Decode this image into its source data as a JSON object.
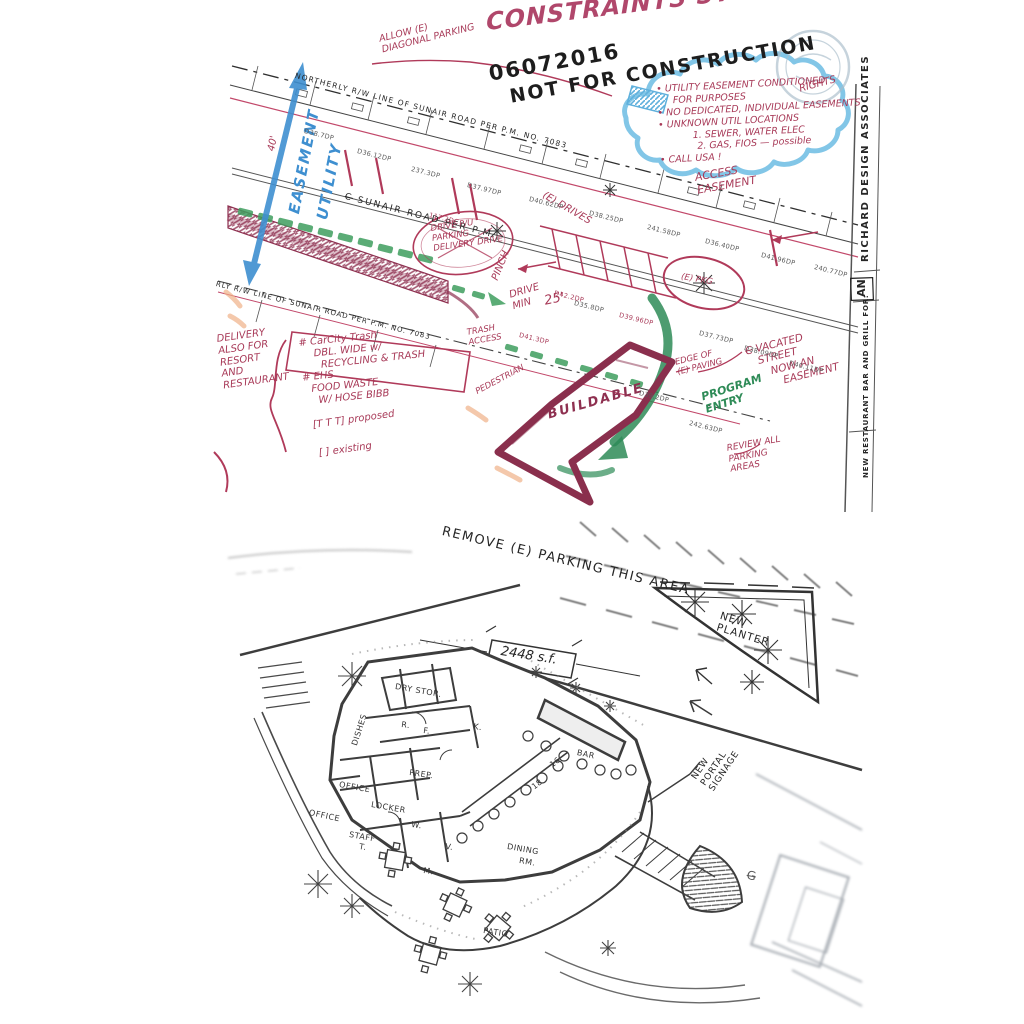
{
  "top_sheet": {
    "title": "CONSTRAINTS STUDY",
    "date": "06072016",
    "stamp": "NOT FOR CONSTRUCTION",
    "allow_parking_lines": [
      "ALLOW (E)",
      "DIAGONAL PARKING"
    ],
    "cloud_note_lines": [
      "• UTILITY EASEMENT CONDITIONED",
      "FOR PURPOSES",
      "• NO DEDICATED, INDIVIDUAL EASEMENTS",
      "• UNKNOWN UTIL LOCATIONS",
      "1. SEWER, WATER ELEC",
      "2. GAS, FIOS — possible",
      "• CALL USA !"
    ],
    "rights_note": "RIGHTS",
    "access_easement_lines": [
      "ACCESS",
      "EASEMENT"
    ],
    "northerly_rw": "NORTHERLY R/W LINE OF SUNAIR ROAD PER P.M. NO. 7083",
    "centerline_road": "C SUNAIR ROAD PER P.M.",
    "southerly_rw": "RLY R/W LINE OF SUNAIR ROAD PER P.M. NO. 7083",
    "easement_word": "EASEMENT",
    "utility_word": "UTILITY",
    "easement_width": "40'",
    "e_drives": "(E) DRIVES",
    "drive_cloud_lines": [
      "DRIVE P/U",
      "PARKING",
      "DELIVERY DRIVE"
    ],
    "pinch": "PINCH",
    "drive_min_lines": [
      "DRIVE",
      "MIN"
    ],
    "drive_dim": "25'",
    "e_pkg": "(E) PKG",
    "trash_access_lines": [
      "TRASH",
      "ACCESS"
    ],
    "pedestrian": "PEDESTRIAN",
    "buildable": "BUILDABLE",
    "program_entry_lines": [
      "PROGRAM",
      "ENTRY"
    ],
    "vacated_lines": [
      "C VACATED",
      "STREET",
      "NOW AN",
      "EASEMENT"
    ],
    "edge_paving_lines": [
      "EDGE OF",
      "(E) PAVING"
    ],
    "review_lines": [
      "REVIEW ALL",
      "PARKING",
      "AREAS"
    ],
    "delivery_lines": [
      "DELIVERY",
      "ALSO FOR",
      "RESORT",
      "AND",
      "RESTAURANT"
    ],
    "trash_note_lines": [
      "# CarCity Trash",
      "DBL. WIDE w/",
      "RECYCLING & TRASH",
      "# EHS",
      "FOOD WASTE",
      "W/ HOSE BIBB"
    ],
    "proposed_note": "[T T T]  proposed",
    "existing_note": "[ ]  existing",
    "titleblock_firm": "RICHARD DESIGN ASSOCIATES",
    "titleblock_logo": "AN",
    "titleblock_project": "NEW RESTAURANT BAR AND GRILL FOR:",
    "survey_marks": [
      {
        "text": "D38.7DP",
        "x": 305,
        "y": 128,
        "rot": 14
      },
      {
        "text": "D36.12DP",
        "x": 358,
        "y": 148,
        "rot": 14
      },
      {
        "text": "237.3DP",
        "x": 412,
        "y": 166,
        "rot": 14
      },
      {
        "text": "D37.97DP",
        "x": 468,
        "y": 182,
        "rot": 14
      },
      {
        "text": "D40.62DP",
        "x": 530,
        "y": 196,
        "rot": 14
      },
      {
        "text": "D38.25DP",
        "x": 590,
        "y": 210,
        "rot": 14
      },
      {
        "text": "241.58DP",
        "x": 648,
        "y": 224,
        "rot": 14
      },
      {
        "text": "D36.40DP",
        "x": 706,
        "y": 238,
        "rot": 14
      },
      {
        "text": "D41.96DP",
        "x": 762,
        "y": 252,
        "rot": 14
      },
      {
        "text": "240.77DP",
        "x": 815,
        "y": 264,
        "rot": 14
      },
      {
        "text": "D35.8DP",
        "x": 575,
        "y": 300,
        "rot": 14
      },
      {
        "text": "D37.73DP",
        "x": 700,
        "y": 330,
        "rot": 14
      },
      {
        "text": "D38.09DP",
        "x": 745,
        "y": 345,
        "rot": 14
      },
      {
        "text": "D40.11DP",
        "x": 790,
        "y": 360,
        "rot": 14
      },
      {
        "text": "D39.2DP",
        "x": 640,
        "y": 390,
        "rot": 14
      },
      {
        "text": "242.63DP",
        "x": 690,
        "y": 420,
        "rot": 14
      }
    ],
    "survey_marks_red": [
      {
        "text": "117.2DC",
        "x": 430,
        "y": 212,
        "rot": 14
      },
      {
        "text": "D42.2DP",
        "x": 555,
        "y": 290,
        "rot": 14
      },
      {
        "text": "D39.96DP",
        "x": 620,
        "y": 312,
        "rot": 14
      },
      {
        "text": "D41.3DP",
        "x": 520,
        "y": 332,
        "rot": 14
      }
    ]
  },
  "bottom_sheet": {
    "remove_parking": "REMOVE (E) PARKING THIS AREA",
    "area": "2448 s.f.",
    "planter_lines": [
      "NEW",
      "PLANTER"
    ],
    "portal_lines": [
      "NEW",
      "PORTAL",
      "SIGNAGE"
    ],
    "gas_mark": "G",
    "room_labels": [
      {
        "text": "DRY STOR.",
        "x": 396,
        "y": 170,
        "rot": 10
      },
      {
        "text": "DISHES",
        "x": 350,
        "y": 232,
        "rot": -72
      },
      {
        "text": "R.",
        "x": 402,
        "y": 208,
        "rot": 8
      },
      {
        "text": "F.",
        "x": 424,
        "y": 214,
        "rot": 8
      },
      {
        "text": "K.",
        "x": 474,
        "y": 210,
        "rot": 8
      },
      {
        "text": "PREP.",
        "x": 410,
        "y": 256,
        "rot": 8
      },
      {
        "text": "OFFICE",
        "x": 340,
        "y": 268,
        "rot": 10
      },
      {
        "text": "OFFICE",
        "x": 310,
        "y": 296,
        "rot": 12
      },
      {
        "text": "LOCKER",
        "x": 372,
        "y": 288,
        "rot": 10
      },
      {
        "text": "STAFF",
        "x": 350,
        "y": 318,
        "rot": 10
      },
      {
        "text": "T.",
        "x": 360,
        "y": 330,
        "rot": 10
      },
      {
        "text": "W.",
        "x": 412,
        "y": 308,
        "rot": 8
      },
      {
        "text": "V.",
        "x": 446,
        "y": 330,
        "rot": 8
      },
      {
        "text": "M.",
        "x": 424,
        "y": 354,
        "rot": 8
      },
      {
        "text": "BAR",
        "x": 578,
        "y": 236,
        "rot": 12
      },
      {
        "text": "16",
        "x": 548,
        "y": 250,
        "rot": -37
      },
      {
        "text": "18",
        "x": 530,
        "y": 272,
        "rot": -37
      },
      {
        "text": "DINING",
        "x": 508,
        "y": 330,
        "rot": 10
      },
      {
        "text": "RM.",
        "x": 520,
        "y": 344,
        "rot": 10
      },
      {
        "text": "PATIO",
        "x": 484,
        "y": 414,
        "rot": 9
      }
    ]
  }
}
